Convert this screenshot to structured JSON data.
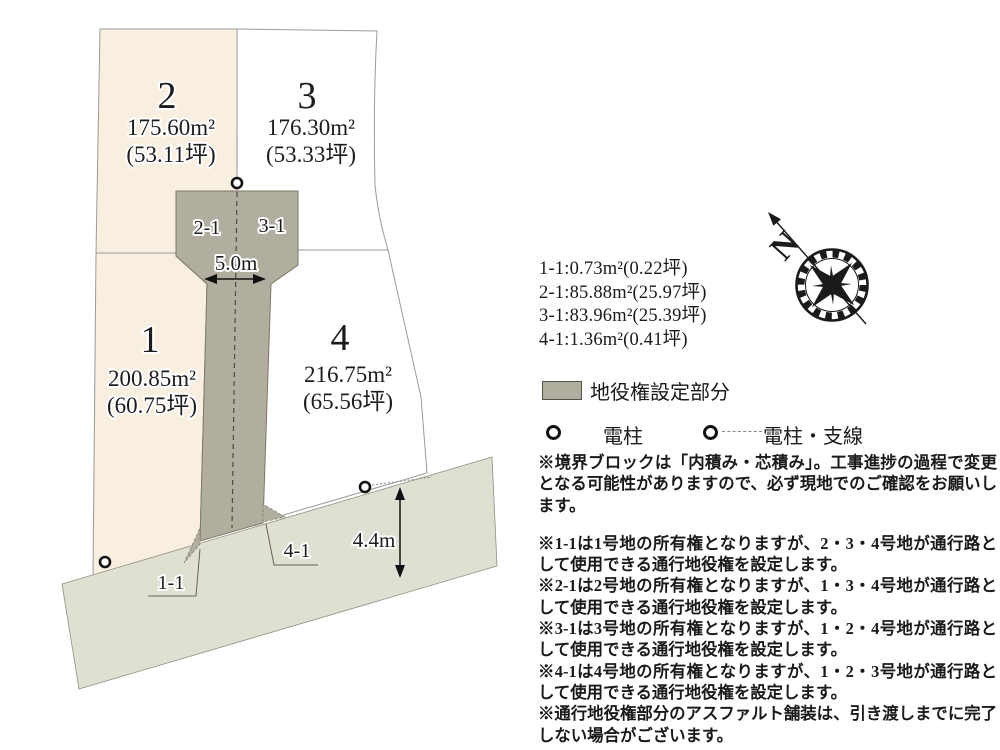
{
  "map": {
    "parcels": [
      {
        "no": "2",
        "area": "175.60m²",
        "tsubo": "(53.11坪)"
      },
      {
        "no": "3",
        "area": "176.30m²",
        "tsubo": "(53.33坪)"
      },
      {
        "no": "1",
        "area": "200.85m²",
        "tsubo": "(60.75坪)"
      },
      {
        "no": "4",
        "area": "216.75m²",
        "tsubo": "(65.56坪)"
      }
    ],
    "easements": {
      "e21": "2-1",
      "e31": "3-1",
      "e11": "1-1",
      "e41": "4-1"
    },
    "dimensions": {
      "road_width": "5.0m",
      "front_road": "4.4m"
    },
    "compass": {
      "north": "N"
    }
  },
  "sidebar": {
    "easement_list": [
      "1-1:0.73m²(0.22坪)",
      "2-1:85.88m²(25.97坪)",
      "3-1:83.96m²(25.39坪)",
      "4-1:1.36m²(0.41坪)"
    ],
    "legend": {
      "easement": "地役権設定部分",
      "pole": "電柱",
      "pole_guy": "電柱・支線"
    },
    "notes": [
      "※境界ブロックは「内積み・芯積み」。工事進捗の過程で変更となる可能性がありますので、必ず現地でのご確認をお願いします。",
      "※1-1は1号地の所有権となりますが、2・3・4号地が通行路として使用できる通行地役権を設定します。",
      "※2-1は2号地の所有権となりますが、1・3・4号地が通行路として使用できる通行地役権を設定します。",
      "※3-1は3号地の所有権となりますが、1・2・4号地が通行路として使用できる通行地役権を設定します。",
      "※4-1は4号地の所有権となりますが、1・2・3号地が通行路として使用できる通行地役権を設定します。",
      "※通行地役権部分のアスファルト舗装は、引き渡しまでに完了しない場合がございます。"
    ]
  },
  "colors": {
    "parcel_cream": "#f9efe1",
    "parcel_white": "#ffffff",
    "easement_gray": "#b2ae9f",
    "road_gray": "#dfe0d2",
    "line_dark": "#1a1a1a"
  }
}
